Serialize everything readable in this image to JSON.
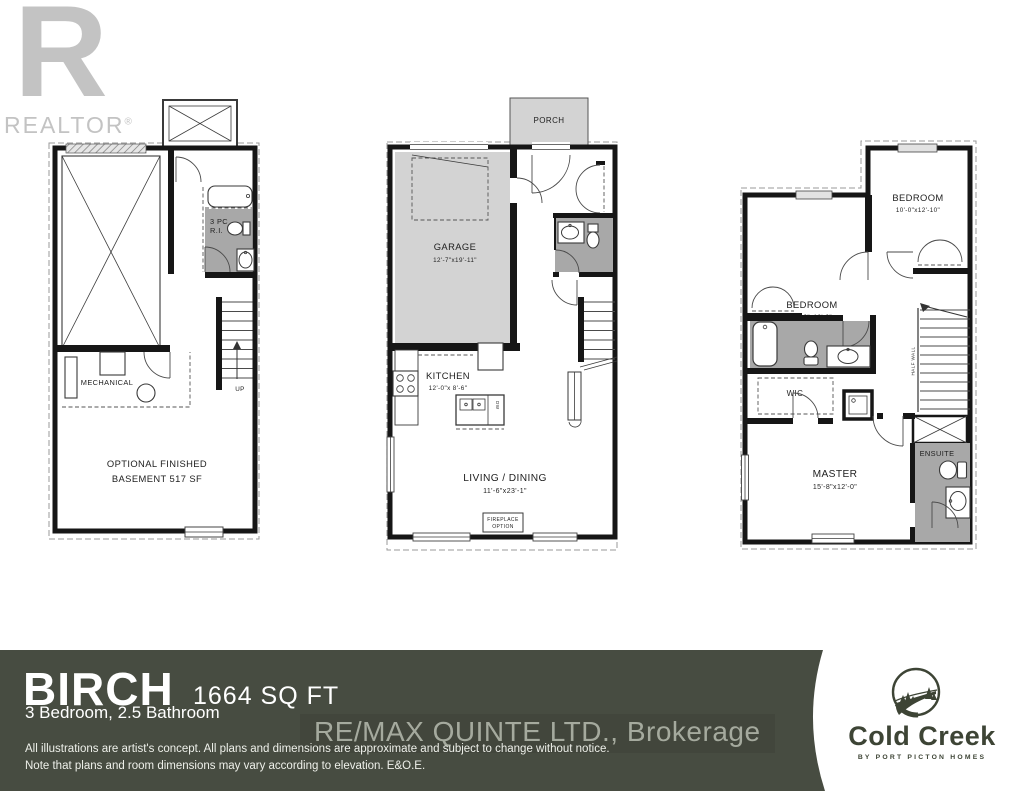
{
  "branding": {
    "realtor_r": "R",
    "realtor_text": "REALTOR",
    "realtor_reg": "®"
  },
  "plans": {
    "basement": {
      "bath_line1": "3 PC",
      "bath_line2": "R.I.",
      "mechanical": "MECHANICAL",
      "optional_line1": "OPTIONAL FINISHED",
      "optional_line2": "BASEMENT 517 SF",
      "up": "UP"
    },
    "main": {
      "porch": "PORCH",
      "garage": "GARAGE",
      "garage_dims": "12'-7\"x19'-11\"",
      "kitchen": "KITCHEN",
      "kitchen_dims": "12'-0\"x 8'-6\"",
      "living": "LIVING / DINING",
      "living_dims": "11'-6\"x23'-1\"",
      "fireplace_line1": "FIREPLACE",
      "fireplace_line2": "OPTION",
      "dw": "DW"
    },
    "second": {
      "bedroom_left": "BEDROOM",
      "bedroom_left_dims": "11'-0\"x13'-0\"",
      "bedroom_right": "BEDROOM",
      "bedroom_right_dims": "10'-0\"x12'-10\"",
      "wic": "WIC",
      "half_wall": "HALF WALL",
      "master": "MASTER",
      "master_dims": "15'-8\"x12'-0\"",
      "ensuite": "ENSUITE"
    }
  },
  "banner": {
    "model_name": "BIRCH",
    "sqft": "1664 SQ FT",
    "specs": "3 Bedroom, 2.5 Bathroom",
    "brokerage": "RE/MAX QUINTE LTD., Brokerage",
    "disclaimer_line1": "All illustrations are artist's concept. All plans and dimensions are approximate and subject to change without notice.",
    "disclaimer_line2": "Note that plans and room dimensions may vary according to elevation. E&O.E.",
    "coldcreek_name": "Cold Creek",
    "coldcreek_tagline": "BY PORT PICTON HOMES"
  },
  "colors": {
    "banner_bg": "#474c41",
    "room_fill_light": "#d3d3d3",
    "room_fill_dark": "#a8a8a8",
    "logo_gray": "#c3c3c3",
    "coldcreek_green": "#3d4435"
  }
}
